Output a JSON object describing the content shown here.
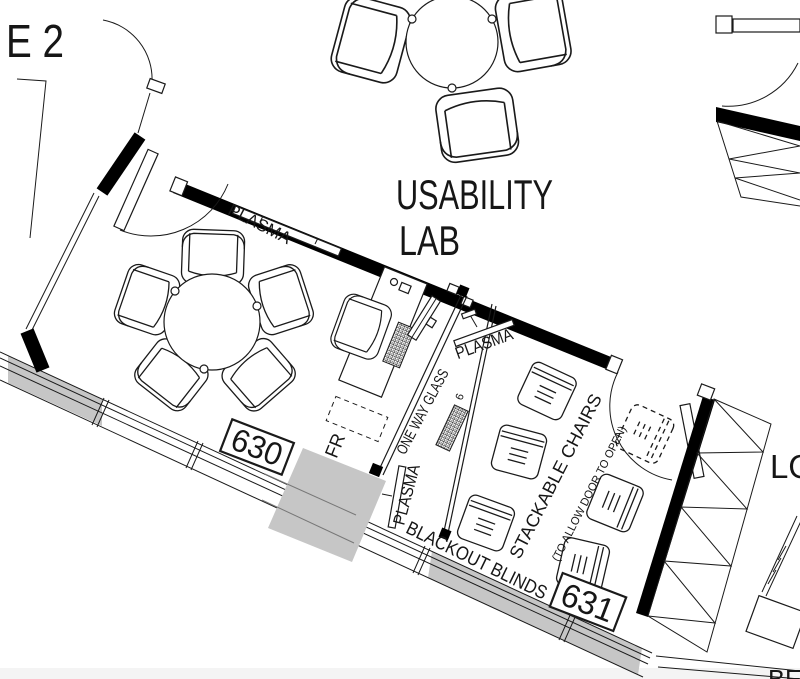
{
  "title": {
    "line1": "USABILITY",
    "line2": "LAB"
  },
  "rooms": {
    "focus_room": "630",
    "observation_room": "631"
  },
  "labels": {
    "plasma": "PLASMA",
    "one_way_glass": "ONE WAY GLASS",
    "stackable_chairs": "STACKABLE CHAIRS",
    "stackable_chairs_note": "(TO ALLOW DOOR TO OPEN)",
    "blackout_blinds": "BLACKOUT BLINDS",
    "fridge": "FR",
    "equipment_mark": "6"
  },
  "edge_text": {
    "top_left": "E 2",
    "right": "LO",
    "bottom_right": "BE"
  },
  "colors": {
    "background": "#ffffff",
    "line": "#1a1a1a",
    "wall": "#000000",
    "panel_gray": "#c6c6c6",
    "floor_strip": "#f4f4f4"
  }
}
